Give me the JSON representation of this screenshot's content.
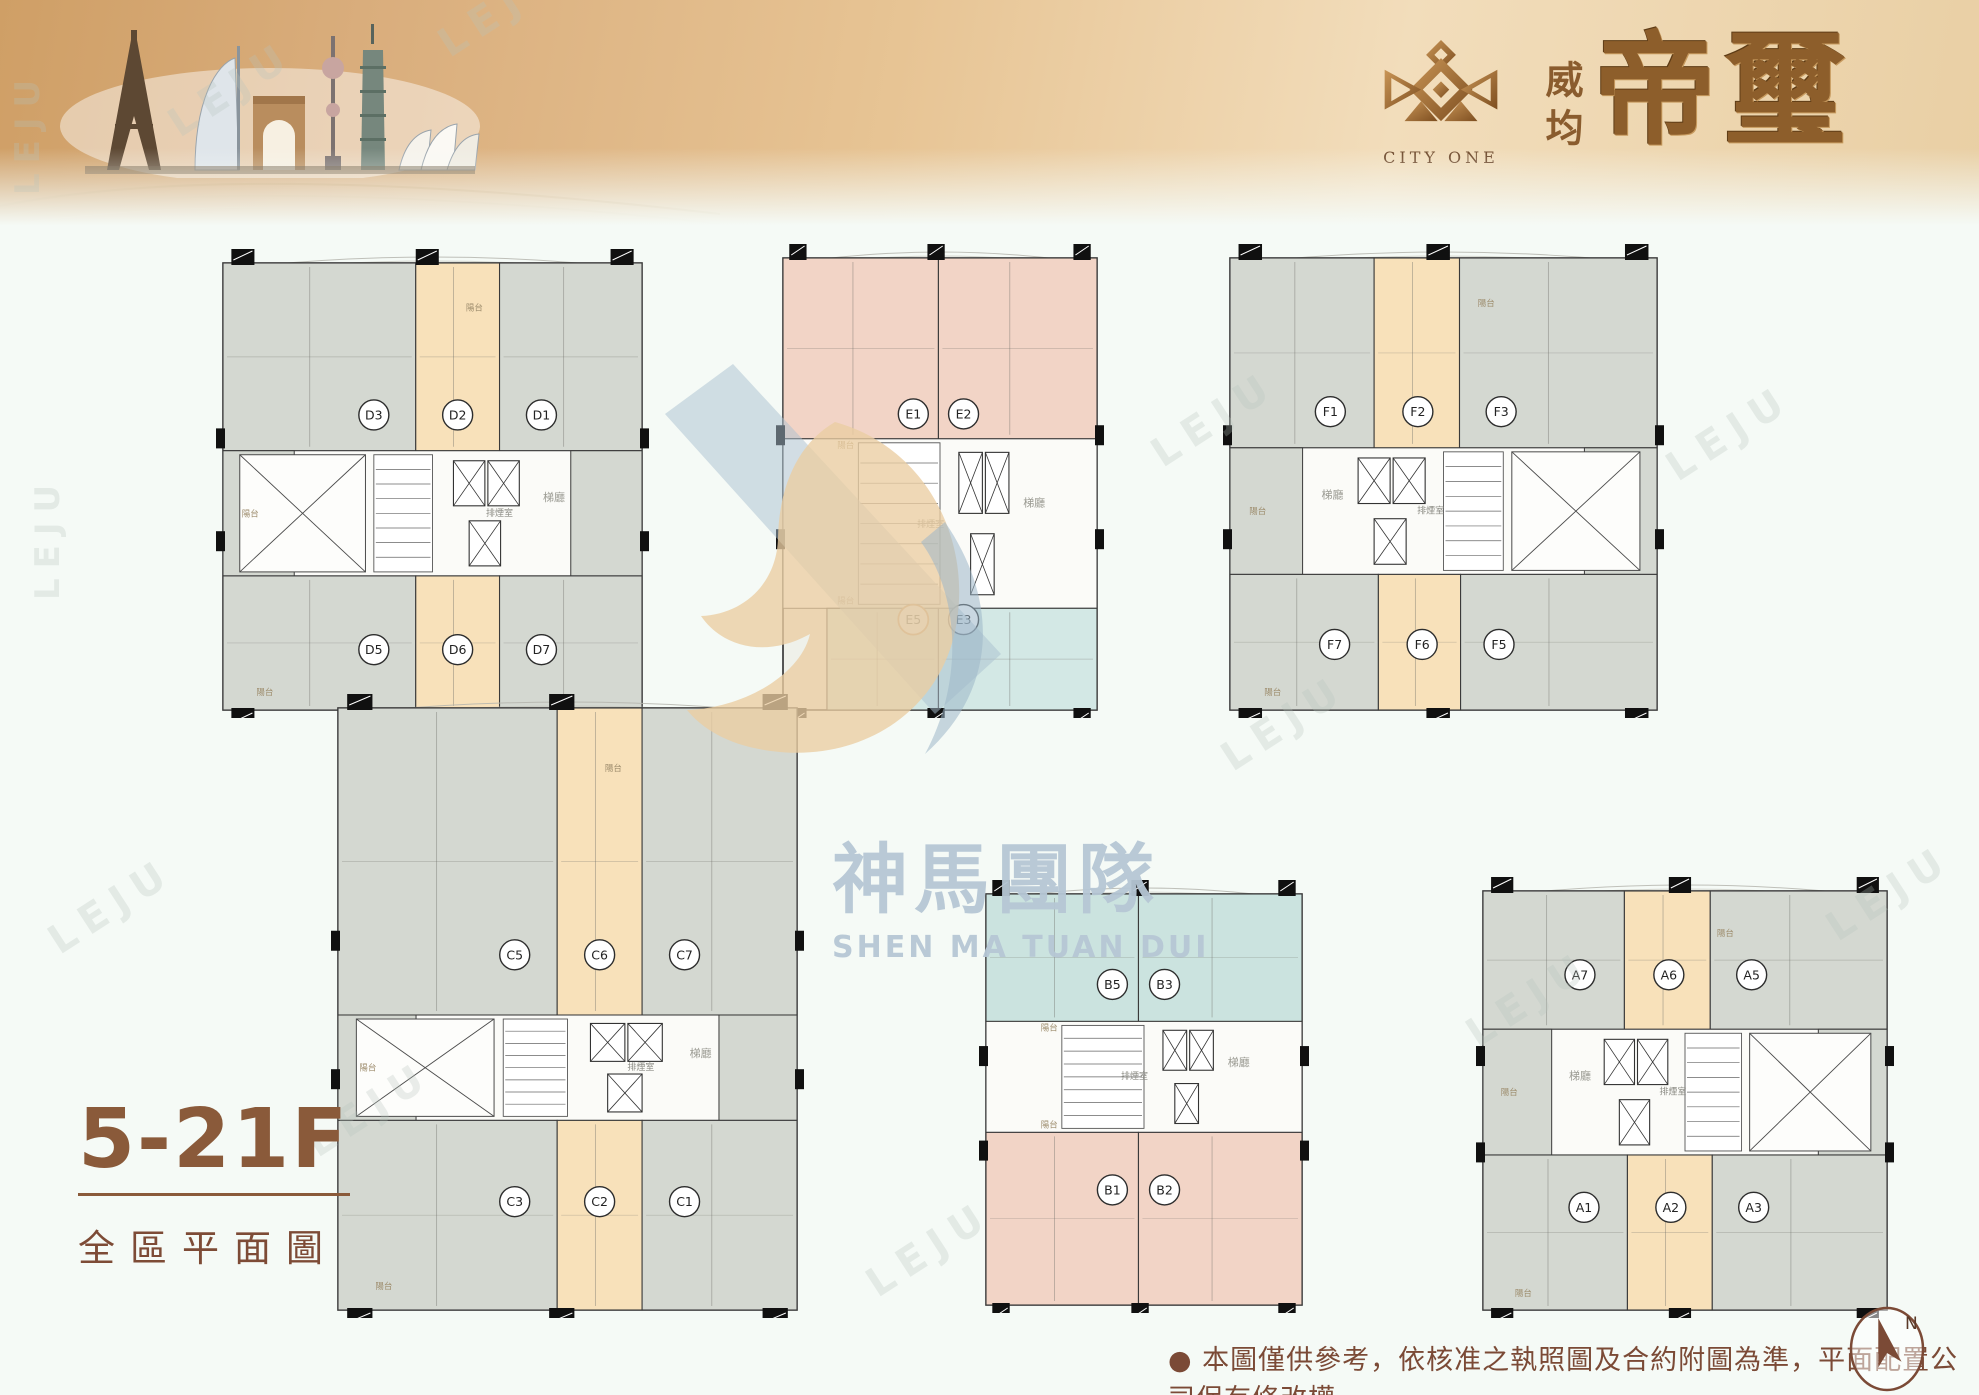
{
  "banner": {
    "logo_text": "CITY ONE",
    "brand_small": "威均",
    "brand_large": "帝璽",
    "skyline_alt": "world-landmarks-skyline"
  },
  "watermark": {
    "cn": "神馬團隊",
    "en": "SHEN MA TUAN DUI"
  },
  "leju": {
    "text": "LEJU",
    "positions": [
      {
        "x": 430,
        "y": 28,
        "r": -33,
        "s": 40
      },
      {
        "x": 160,
        "y": 108,
        "r": -33,
        "s": 40
      },
      {
        "x": 8,
        "y": 195,
        "r": -90,
        "s": 34
      },
      {
        "x": 28,
        "y": 600,
        "r": -90,
        "s": 34
      },
      {
        "x": 40,
        "y": 925,
        "r": -33,
        "s": 40
      },
      {
        "x": 298,
        "y": 1128,
        "r": -33,
        "s": 40
      },
      {
        "x": 858,
        "y": 1268,
        "r": -33,
        "s": 40
      },
      {
        "x": 1213,
        "y": 742,
        "r": -33,
        "s": 40
      },
      {
        "x": 1143,
        "y": 438,
        "r": -33,
        "s": 40
      },
      {
        "x": 1658,
        "y": 452,
        "r": -33,
        "s": 40
      },
      {
        "x": 1818,
        "y": 912,
        "r": -33,
        "s": 40
      },
      {
        "x": 1458,
        "y": 1018,
        "r": -33,
        "s": 40
      }
    ]
  },
  "title_block": {
    "floors": "5-21F",
    "subtitle": "全區平面圖"
  },
  "footer": {
    "disclaimer": "● 本圖僅供參考，依核准之執照圖及合約附圖為準，平面配置公司保有修改權",
    "compass_n": "N"
  },
  "colors": {
    "gray": "#d4d8d1",
    "peach": "#f8e1ba",
    "pink": "#f2d4c6",
    "teal": "#cbe3df",
    "blue": "#d3e8e5",
    "plan_base": "#eff1ea",
    "outline": "#2e2e2e",
    "brown": "#8a5a3a",
    "gold": "#a97a3f",
    "wm_blue": "#b6c7d5",
    "wm_tan": "#ebcda2"
  },
  "plan_labels": {
    "balcony": "陽台",
    "stair_hall": "梯廳",
    "smoke_room": "排煙室"
  },
  "plans": [
    {
      "id": "d",
      "pos": {
        "left": 215,
        "top": 237,
        "width": 435,
        "height": 463
      },
      "layout": "wide",
      "mirror": false,
      "bands": {
        "top": 0.42,
        "bot": 0.7
      },
      "rows": {
        "top": 0.34,
        "bottom": 0.865
      },
      "top_units": [
        {
          "label": "D3",
          "color": "gray",
          "lx": 0.36
        },
        {
          "label": "D2",
          "color": "peach",
          "lx": 0.56
        },
        {
          "label": "D1",
          "color": "gray",
          "lx": 0.76
        }
      ],
      "bottom_units": [
        {
          "label": "D5",
          "color": "gray",
          "lx": 0.36
        },
        {
          "label": "D6",
          "color": "peach",
          "lx": 0.56
        },
        {
          "label": "D7",
          "color": "gray",
          "lx": 0.76
        }
      ]
    },
    {
      "id": "e",
      "pos": {
        "left": 775,
        "top": 232,
        "width": 330,
        "height": 468
      },
      "layout": "tall",
      "mirror": false,
      "bottom_start": 0.14,
      "bands": {
        "top": 0.4,
        "bot": 0.775
      },
      "rows": {
        "top": 0.345,
        "bottom": 0.8
      },
      "top_units": [
        {
          "label": "E1",
          "color": "pink",
          "lx": 0.415
        },
        {
          "label": "E2",
          "color": "pink",
          "lx": 0.575
        }
      ],
      "bottom_units": [
        {
          "label": "E5",
          "color": "blue",
          "lx": 0.415,
          "ring": "#c0792f"
        },
        {
          "label": "E3",
          "color": "blue",
          "lx": 0.575
        }
      ]
    },
    {
      "id": "f",
      "pos": {
        "left": 1222,
        "top": 232,
        "width": 443,
        "height": 468
      },
      "layout": "wide",
      "mirror": true,
      "bands": {
        "top": 0.42,
        "bot": 0.7
      },
      "rows": {
        "top": 0.34,
        "bottom": 0.855
      },
      "top_units": [
        {
          "label": "F1",
          "color": "gray",
          "lx": 0.235
        },
        {
          "label": "F2",
          "color": "peach",
          "lx": 0.44
        },
        {
          "label": "F3",
          "color": "gray",
          "lx": 0.635
        }
      ],
      "bottom_units": [
        {
          "label": "F7",
          "color": "gray",
          "lx": 0.245
        },
        {
          "label": "F6",
          "color": "peach",
          "lx": 0.45
        },
        {
          "label": "F5",
          "color": "gray",
          "lx": 0.63
        }
      ]
    },
    {
      "id": "c",
      "pos": {
        "left": 330,
        "top": 682,
        "width": 475,
        "height": 618
      },
      "layout": "wide",
      "mirror": false,
      "bands": {
        "top": 0.51,
        "bot": 0.685
      },
      "rows": {
        "top": 0.41,
        "bottom": 0.82
      },
      "top_units": [
        {
          "label": "C5",
          "color": "gray",
          "lx": 0.385
        },
        {
          "label": "C6",
          "color": "peach",
          "lx": 0.57
        },
        {
          "label": "C7",
          "color": "gray",
          "lx": 0.755
        }
      ],
      "bottom_units": [
        {
          "label": "C3",
          "color": "gray",
          "lx": 0.385
        },
        {
          "label": "C2",
          "color": "peach",
          "lx": 0.57
        },
        {
          "label": "C1",
          "color": "gray",
          "lx": 0.755
        }
      ]
    },
    {
      "id": "b",
      "pos": {
        "left": 978,
        "top": 868,
        "width": 332,
        "height": 427
      },
      "layout": "tall",
      "mirror": false,
      "bands": {
        "top": 0.31,
        "bot": 0.58
      },
      "rows": {
        "top": 0.22,
        "bottom": 0.72
      },
      "top_units": [
        {
          "label": "B5",
          "color": "teal",
          "lx": 0.4
        },
        {
          "label": "B3",
          "color": "teal",
          "lx": 0.565
        }
      ],
      "bottom_units": [
        {
          "label": "B1",
          "color": "pink",
          "lx": 0.4
        },
        {
          "label": "B2",
          "color": "pink",
          "lx": 0.565
        }
      ]
    },
    {
      "id": "a",
      "pos": {
        "left": 1475,
        "top": 865,
        "width": 420,
        "height": 435
      },
      "layout": "wide",
      "mirror": true,
      "bands": {
        "top": 0.33,
        "bot": 0.63
      },
      "rows": {
        "top": 0.2,
        "bottom": 0.755
      },
      "top_units": [
        {
          "label": "A7",
          "color": "gray",
          "lx": 0.24
        },
        {
          "label": "A6",
          "color": "peach",
          "lx": 0.46
        },
        {
          "label": "A5",
          "color": "gray",
          "lx": 0.665
        }
      ],
      "bottom_units": [
        {
          "label": "A1",
          "color": "gray",
          "lx": 0.25
        },
        {
          "label": "A2",
          "color": "peach",
          "lx": 0.465
        },
        {
          "label": "A3",
          "color": "gray",
          "lx": 0.67
        }
      ]
    }
  ]
}
